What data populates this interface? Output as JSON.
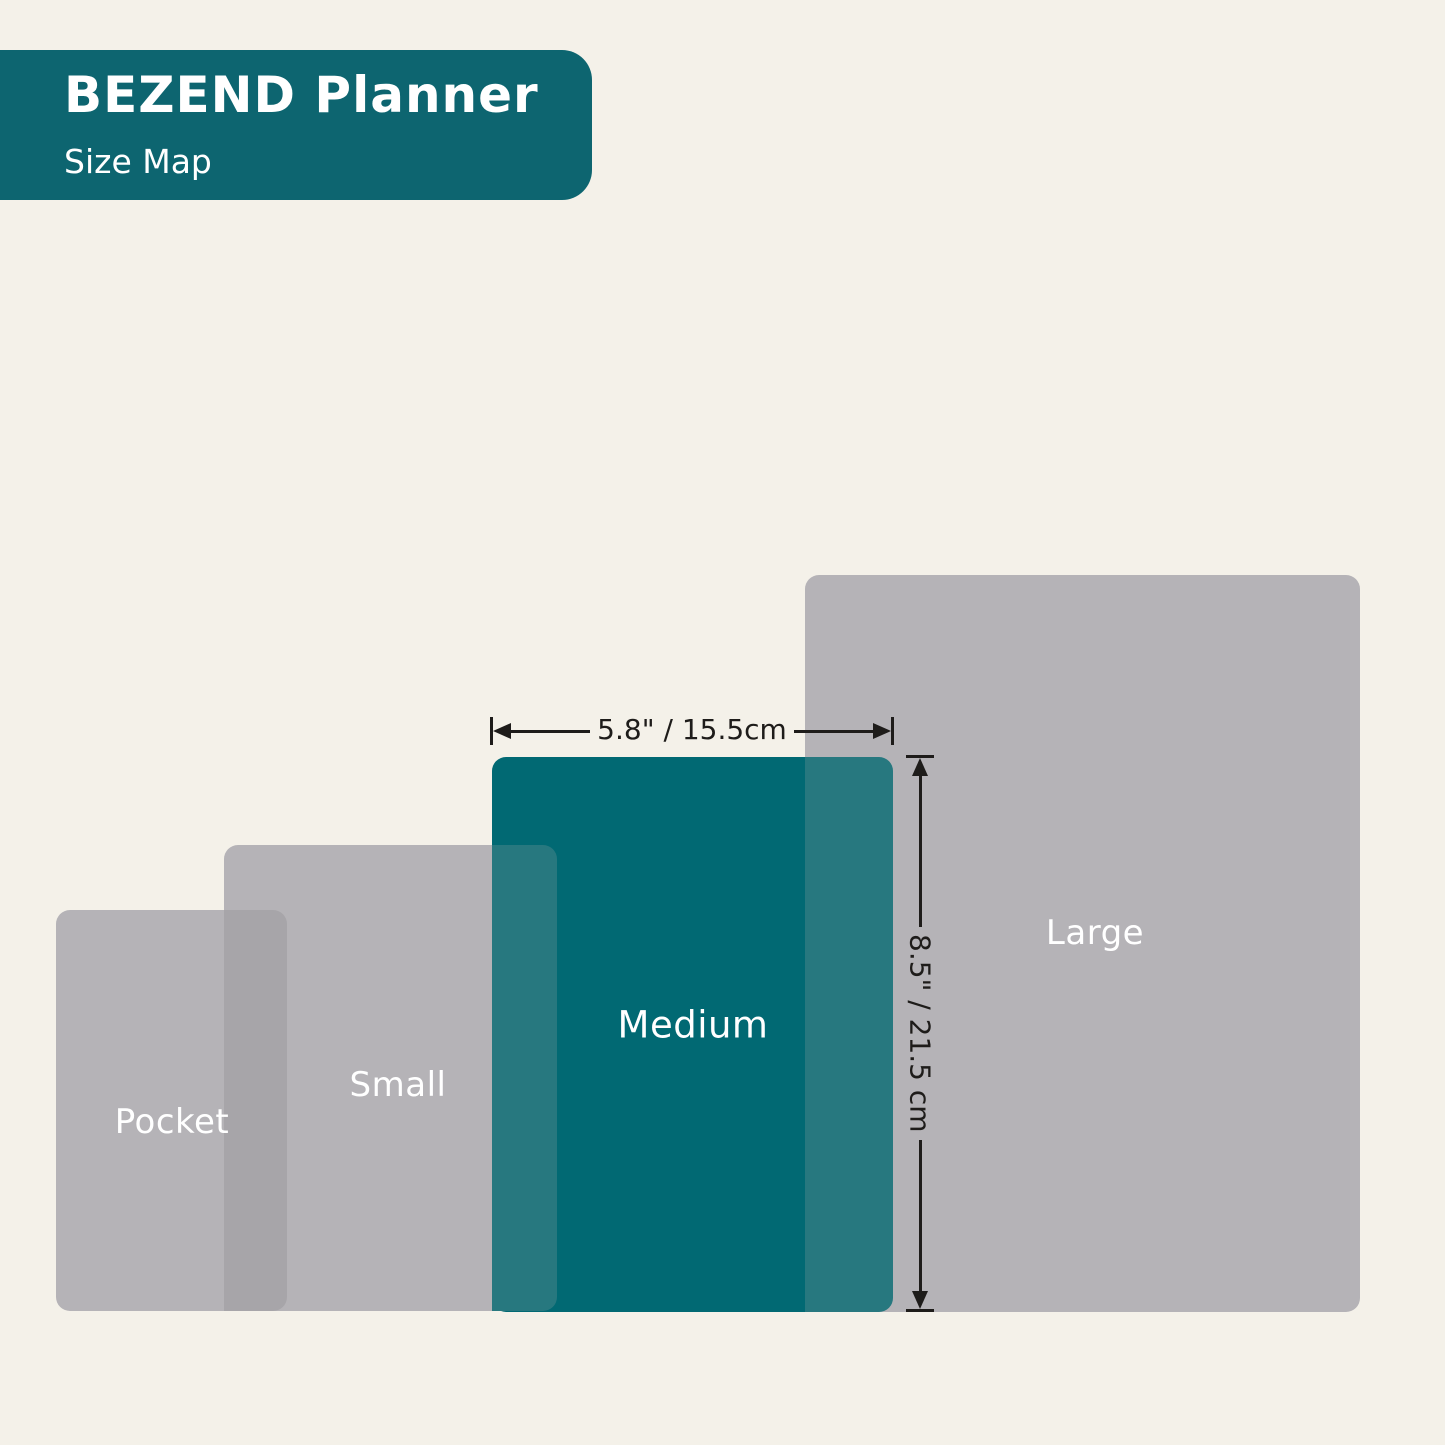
{
  "header": {
    "title": "BEZEND Planner",
    "subtitle": "Size Map"
  },
  "sizes": [
    {
      "name": "Pocket",
      "highlighted": false
    },
    {
      "name": "Small",
      "highlighted": false
    },
    {
      "name": "Medium",
      "highlighted": true
    },
    {
      "name": "Large",
      "highlighted": false
    }
  ],
  "dimensions": {
    "width": "5.8\" / 15.5cm",
    "height": "8.5\" / 21.5 cm"
  },
  "colors": {
    "background": "#f4f1e9",
    "header_teal": "#0d6570",
    "panel_gray": "#b5b3b7",
    "overlap_gray": "#a7a5a9",
    "highlight_teal": "#016973",
    "overlap_teal": "#27787f",
    "line": "#1e1c1a",
    "label_text": "#ffffff"
  }
}
